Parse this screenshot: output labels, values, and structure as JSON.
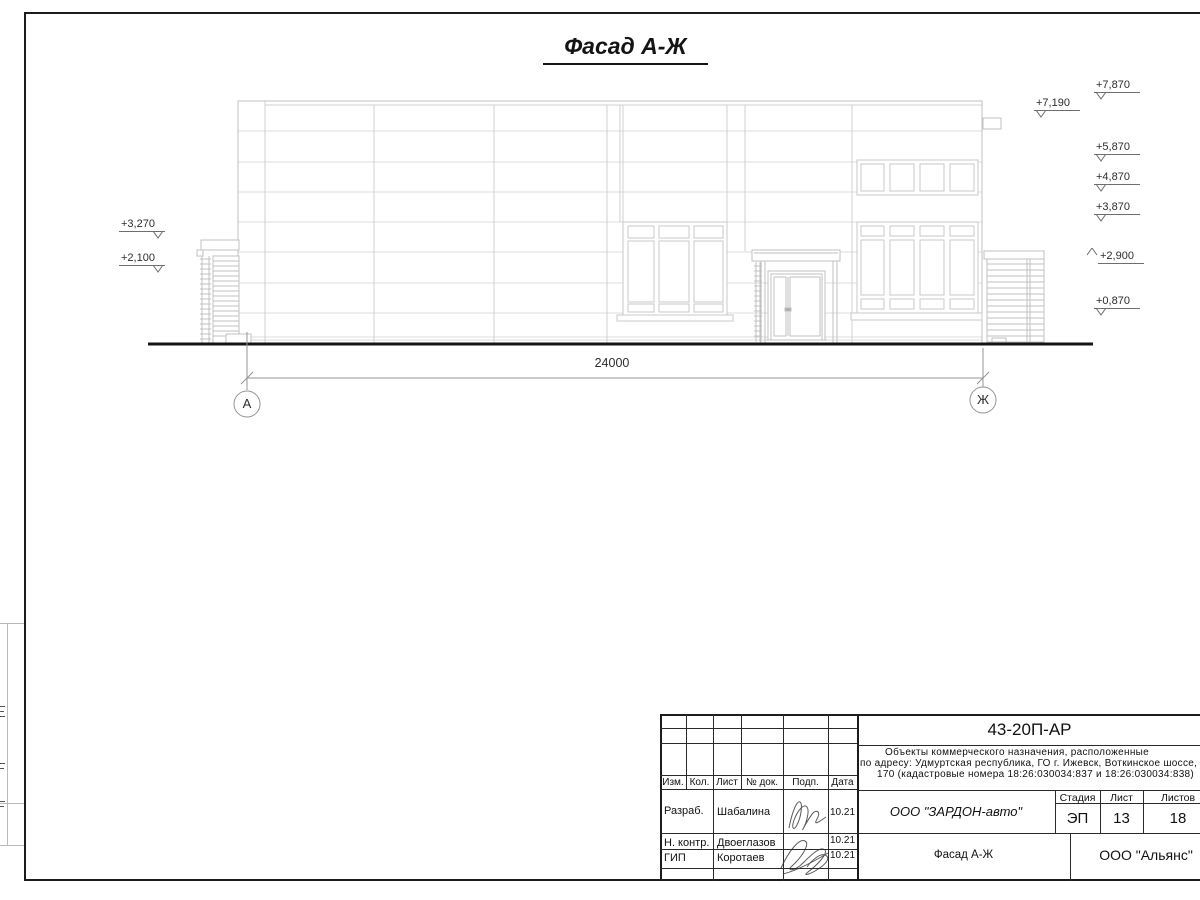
{
  "sheet": {
    "title": "Фасад А-Ж",
    "dimension_label": "24000",
    "axis_left": "А",
    "axis_right": "Ж"
  },
  "elevations": {
    "left": [
      {
        "value": "+3,270"
      },
      {
        "value": "+2,100"
      }
    ],
    "right": [
      {
        "value": "+7,870"
      },
      {
        "value": "+7,190"
      },
      {
        "value": "+5,870"
      },
      {
        "value": "+4,870"
      },
      {
        "value": "+3,870"
      },
      {
        "value": "+2,900"
      },
      {
        "value": "+0,870"
      }
    ]
  },
  "title_block": {
    "doc_number": "43-20П-АР",
    "project_lines": [
      "Объекты коммерческого назначения, расположенные",
      "по адресу: Удмуртская республика, ГО г. Ижевск, Воткинское шоссе,",
      "170 (кадастровые номера 18:26:030034:837 и 18:26:030034:838)"
    ],
    "columns": {
      "izm": "Изм.",
      "kol": "Кол.",
      "list": "Лист",
      "doc": "№ док.",
      "podp": "Подп.",
      "data": "Дата"
    },
    "rows": [
      {
        "role": "Разраб.",
        "name": "Шабалина",
        "date": "10.21"
      },
      {
        "role": "Н. контр.",
        "name": "Двоеглазов",
        "date": "10.21"
      },
      {
        "role": "ГИП",
        "name": "Коротаев",
        "date": "10.21"
      }
    ],
    "company": "ООО \"ЗАРДОН-авто\"",
    "stage_label": "Стадия",
    "sheet_label": "Лист",
    "sheets_label": "Листов",
    "stage": "ЭП",
    "sheet_num": "13",
    "sheets_total": "18",
    "drawing_name": "Фасад А-Ж",
    "org": "ООО \"Альянс\""
  }
}
